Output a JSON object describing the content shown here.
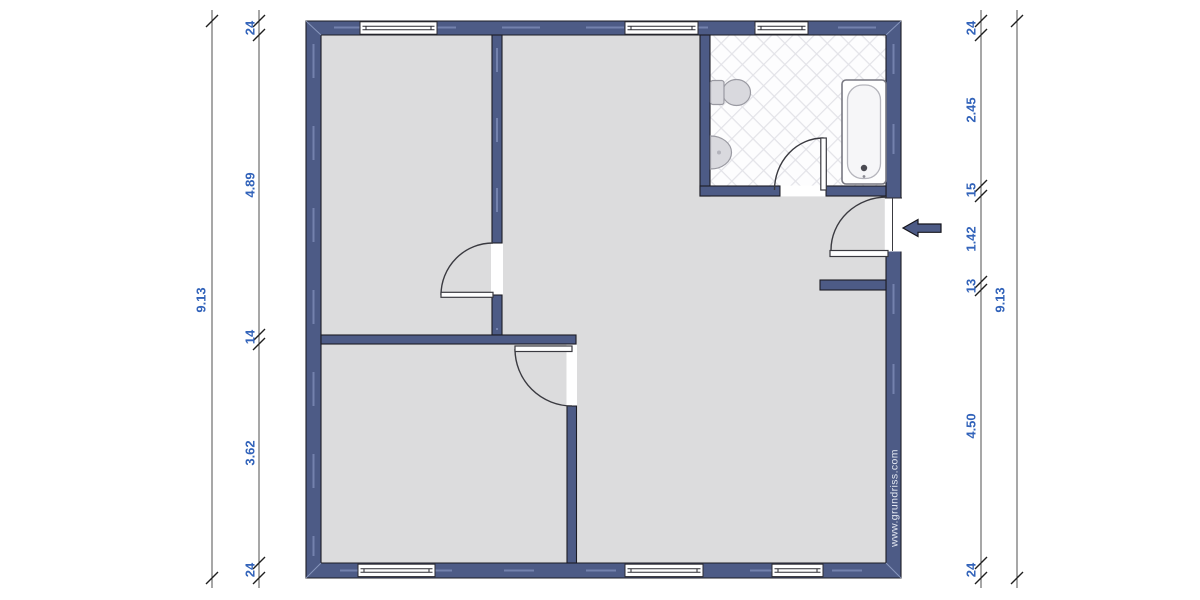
{
  "meta": {
    "watermark": "www.grundriss.com",
    "drawing_type": "floor-plan"
  },
  "colors": {
    "wall": "#4d5b86",
    "wall_highlight": "#7b89b4",
    "floor": "#dcdcdd",
    "bath_tile_bg": "#fdfdfe",
    "bath_tile_line": "#e3e3e8",
    "dimension_text": "#3263ba",
    "dimension_line": "#4f4f4f",
    "outline": "#1c1c24",
    "background": "#ffffff"
  },
  "dimensions": {
    "left_outer": {
      "label": "9.13"
    },
    "left_inner": {
      "labels": [
        "24",
        "4.89",
        "14",
        "3.62",
        "24"
      ]
    },
    "right_inner": {
      "labels": [
        "24",
        "2.45",
        "15",
        "1.42",
        "13",
        "4.50",
        "24"
      ]
    },
    "right_outer": {
      "label": "9.13"
    }
  },
  "fixtures": {
    "items": [
      "toilet",
      "sink",
      "bathtub"
    ],
    "entrance_marker": "arrow-left"
  }
}
